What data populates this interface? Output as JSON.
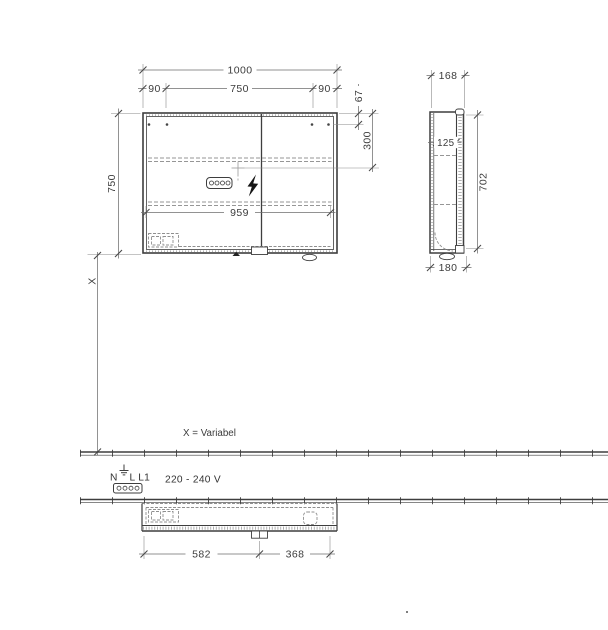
{
  "colors": {
    "line": "#3e3e3e",
    "dim_line": "#6e6e6e",
    "dashed": "#969696",
    "text": "#3c3c3c",
    "background": "#ffffff"
  },
  "front_view": {
    "dim_total_width": "1000",
    "dim_left_offset": "90",
    "dim_center_span": "750",
    "dim_right_offset": "90",
    "dim_top_to_holes": "67",
    "dim_top_to_connection": "300",
    "dim_height": "750",
    "dim_inner_width": "959"
  },
  "side_view": {
    "dim_depth_top": "168",
    "dim_inner_depth": "125",
    "dim_height": "702",
    "dim_depth_bottom": "180"
  },
  "bottom_view": {
    "dim_left_section": "582",
    "dim_right_section": "368"
  },
  "mounting": {
    "x_label": "X",
    "x_note": "X = Variabel"
  },
  "electrical": {
    "terminal_n": "N",
    "terminals_l": "L L1",
    "voltage": "220 - 240 V"
  },
  "symbols": {
    "lightning_bolt": "electrical-connection",
    "power_socket": "4-hole connector",
    "power_connector": "4-hole connector",
    "earth_ground": "PE earth symbol",
    "mounting_holes": "fixing points",
    "door_swing": "door opening arc"
  }
}
